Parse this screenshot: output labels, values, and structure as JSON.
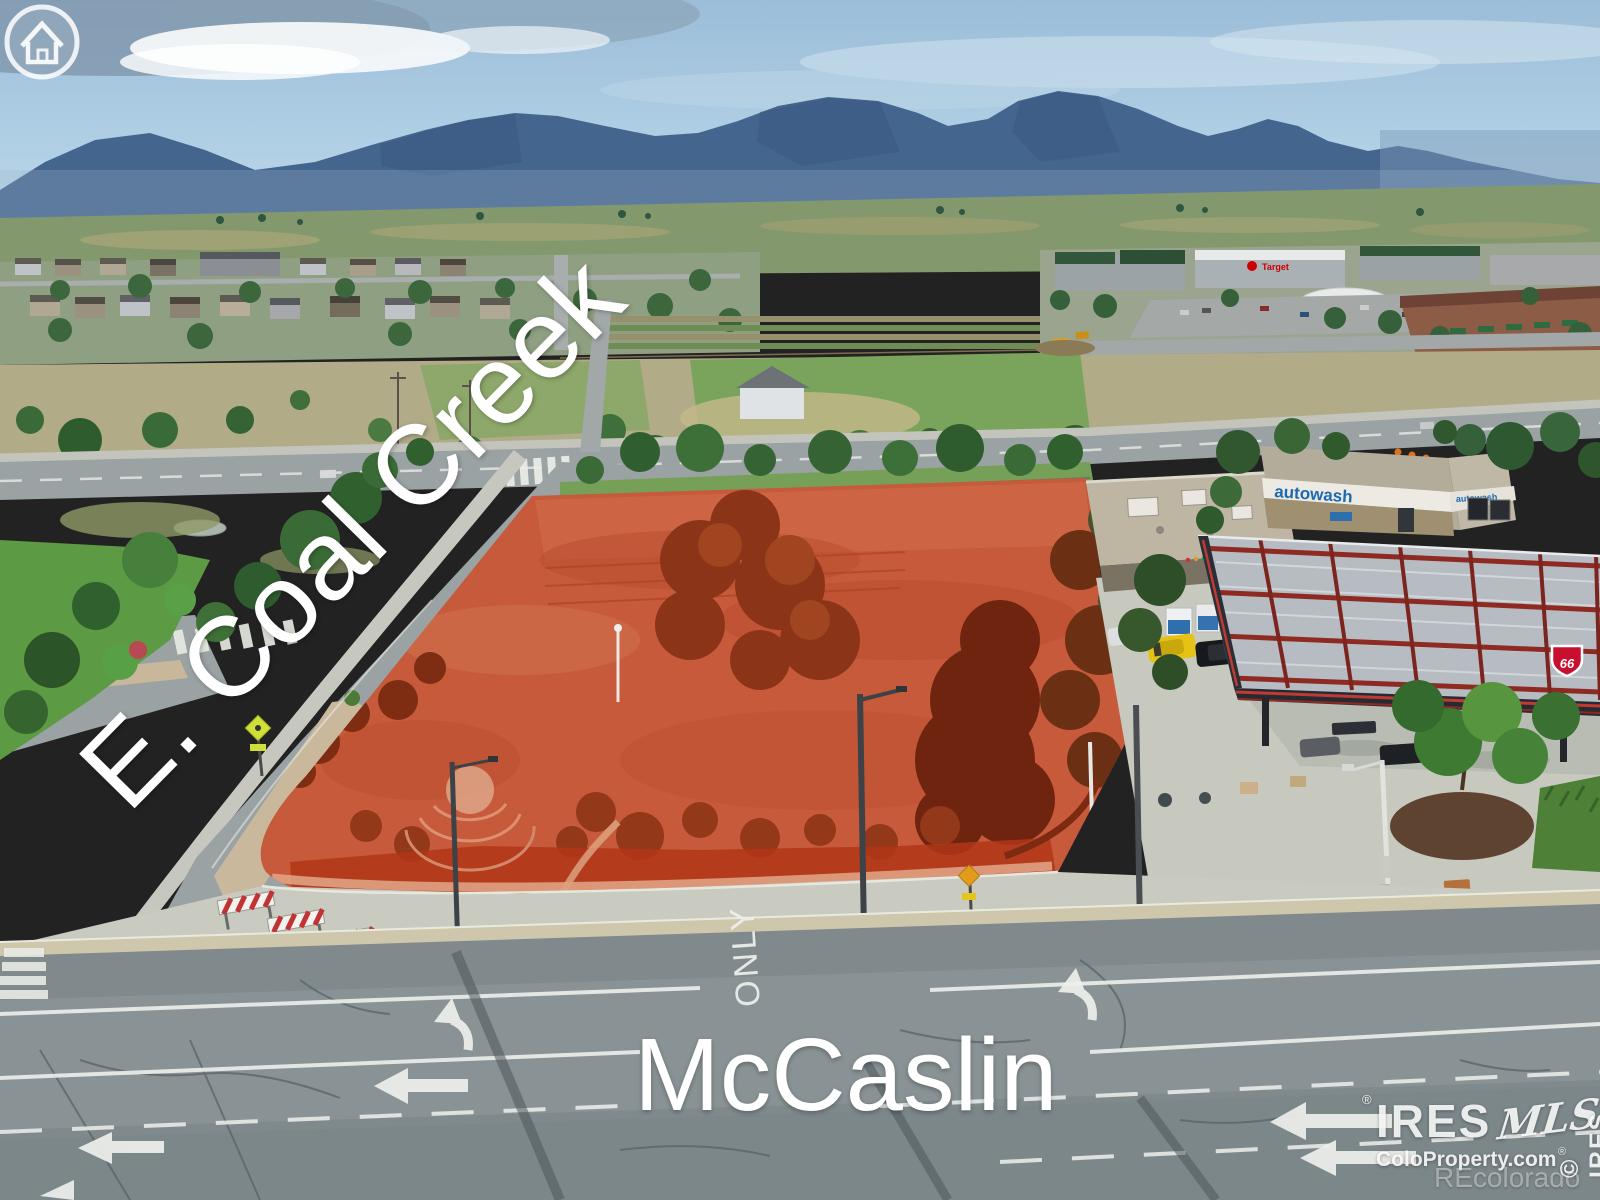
{
  "scene": {
    "description": "Aerial drone photo of a vacant corner parcel highlighted in red at the intersection of E. Coal Creek and McCaslin, with the Rocky Mountain foothills, suburban Louisville development, retail center and a Phillips 66 gas station with car wash."
  },
  "labels": {
    "diagonal_street": "E. Coal Creek",
    "bottom_street": "McCaslin",
    "pavement_marking": "ONLY"
  },
  "signs": {
    "carwash": "autowash",
    "gas_shield": "66",
    "retail_anchor": "Target"
  },
  "watermark": {
    "brand": "IRES",
    "brand_script": "MLS",
    "brand_reg": "®",
    "site": "ColoProperty.com",
    "site_reg": "®",
    "partner": "REcolorado",
    "edge_vertical": "© IRES"
  },
  "colors": {
    "parcel_highlight": "#c65a3a",
    "parcel_mulch": "#b03618",
    "sky_blue": "#a9cade",
    "mountain_blue": "#44658e",
    "canopy_red": "#8e2a22",
    "autowash_blue": "#1c6ab2",
    "phillips66_red": "#c8102e",
    "target_red": "#cc0000",
    "label_text": "#ffffff",
    "asphalt": "#808a8d",
    "gutter_tan": "#cfc7ac",
    "pedestrian_sign": "#cfe03a",
    "safety_orange": "#e07018"
  }
}
